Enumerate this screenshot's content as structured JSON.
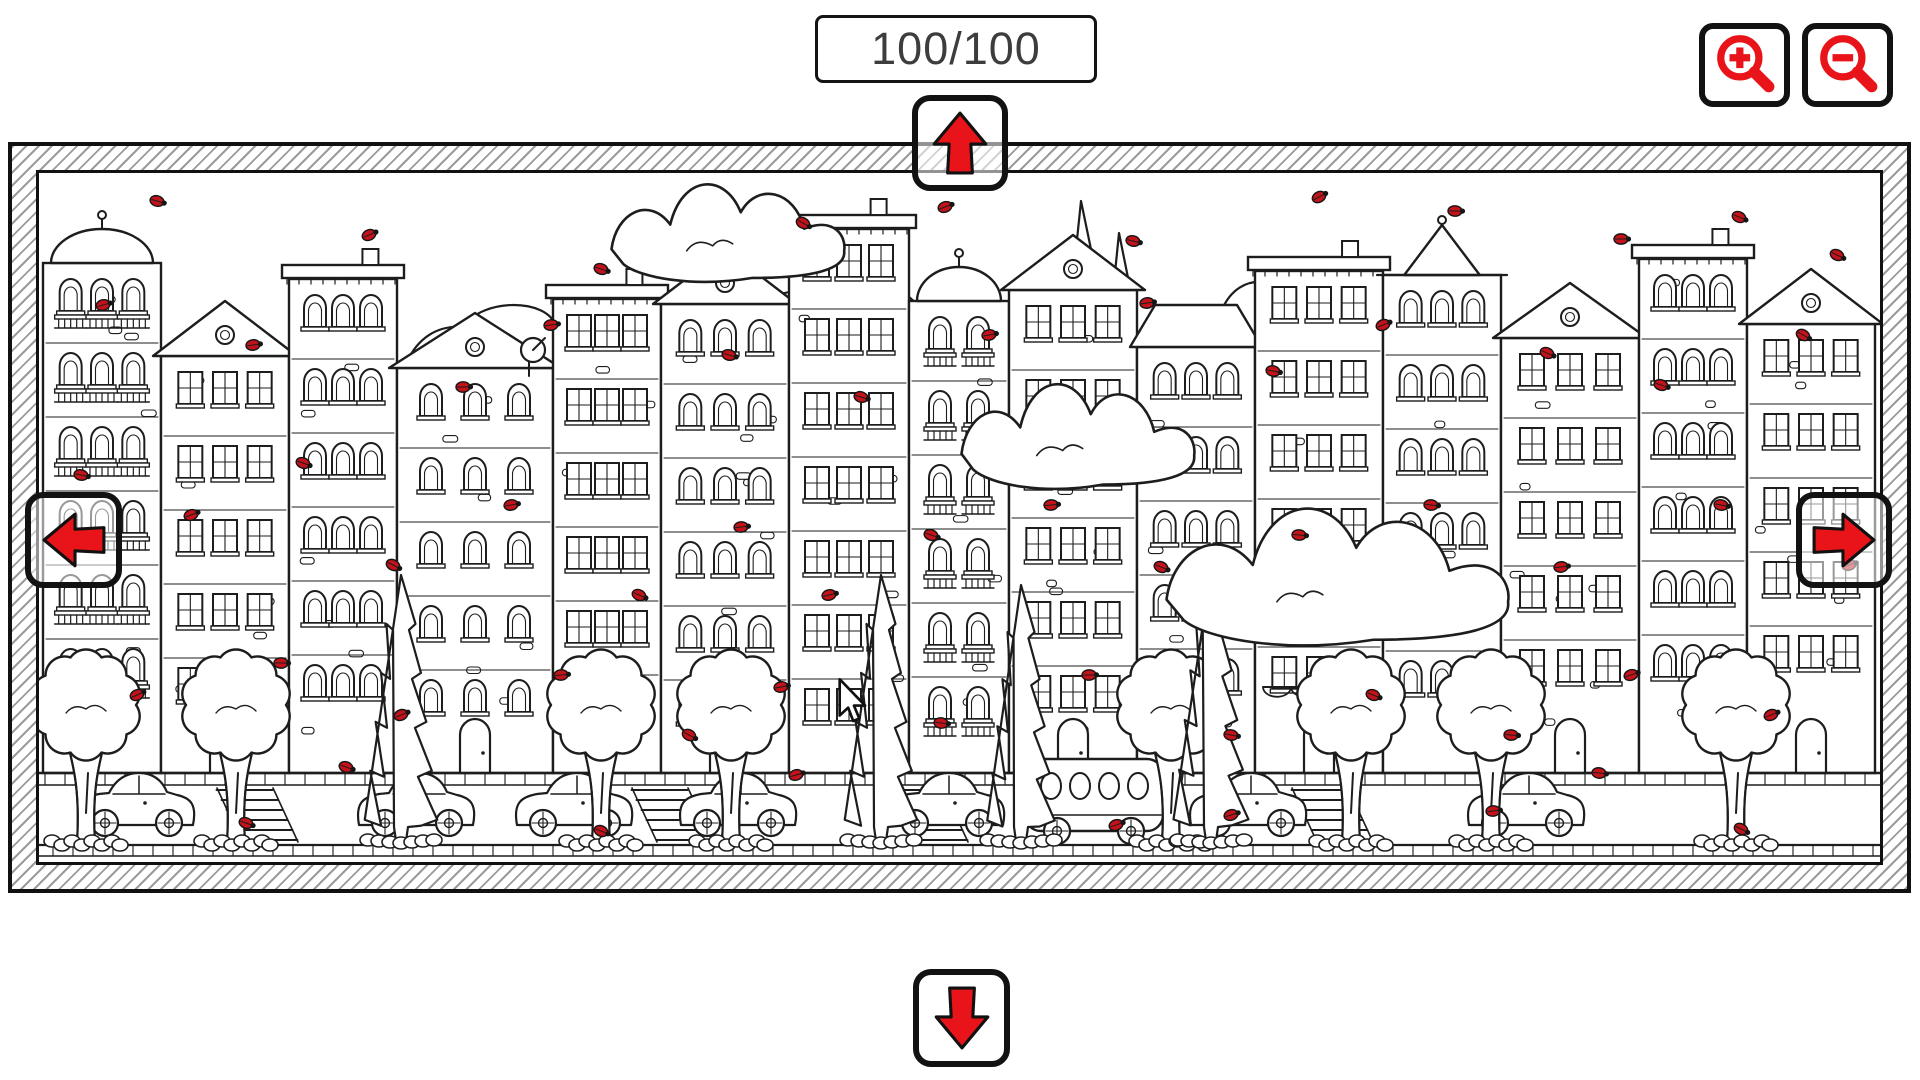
{
  "hud": {
    "counter": "100/100"
  },
  "controls": {
    "zoom_in": {
      "icon": "magnifier-plus-icon"
    },
    "zoom_out": {
      "icon": "magnifier-minus-icon"
    },
    "pan_up": {
      "icon": "arrow-up-icon"
    },
    "pan_down": {
      "icon": "arrow-down-icon"
    },
    "pan_left": {
      "icon": "arrow-left-icon"
    },
    "pan_right": {
      "icon": "arrow-right-icon"
    }
  },
  "cursor": {
    "icon": "mouse-pointer-icon",
    "x": 836,
    "y": 678
  },
  "colors": {
    "accent_red": "#e81419",
    "bug_red": "#c2121a",
    "ink": "#1d1d1d",
    "hatch": "#9b9b9b",
    "counter_text": "#3d3d3d",
    "paper": "#ffffff"
  },
  "scene": {
    "ground_y": 600,
    "road_bottom": 672,
    "bottom_edge": 683,
    "buildings": [
      {
        "x": 4,
        "w": 118,
        "top": 50,
        "roof": "dome",
        "win": "arch",
        "cols": 3,
        "balcony": true
      },
      {
        "x": 122,
        "w": 128,
        "top": 128,
        "roof": "gable",
        "win": "rect",
        "cols": 3,
        "door": true
      },
      {
        "x": 250,
        "w": 108,
        "top": 92,
        "roof": "flat",
        "win": "arch",
        "cols": 3
      },
      {
        "x": 358,
        "w": 156,
        "top": 140,
        "roof": "gable",
        "win": "arch",
        "cols": 3,
        "door": true,
        "dish": true
      },
      {
        "x": 514,
        "w": 108,
        "top": 112,
        "roof": "flat",
        "win": "rect",
        "cols": 3,
        "awning": true
      },
      {
        "x": 622,
        "w": 128,
        "top": 76,
        "roof": "gable",
        "win": "arch",
        "cols": 3,
        "door": true
      },
      {
        "x": 750,
        "w": 120,
        "top": 42,
        "roof": "flat",
        "win": "rect",
        "cols": 3
      },
      {
        "x": 870,
        "w": 100,
        "top": 88,
        "roof": "dome",
        "win": "arch",
        "cols": 2,
        "balcony": true
      },
      {
        "x": 970,
        "w": 128,
        "top": 62,
        "roof": "gable",
        "win": "rect",
        "cols": 3,
        "door": true
      },
      {
        "x": 1098,
        "w": 118,
        "top": 132,
        "roof": "mansard",
        "win": "arch",
        "cols": 3
      },
      {
        "x": 1216,
        "w": 128,
        "top": 84,
        "roof": "flat",
        "win": "rect",
        "cols": 3,
        "door": true,
        "awning": true
      },
      {
        "x": 1344,
        "w": 118,
        "top": 52,
        "roof": "cone",
        "win": "arch",
        "cols": 3
      },
      {
        "x": 1462,
        "w": 138,
        "top": 110,
        "roof": "gable",
        "win": "rect",
        "cols": 3,
        "door": true
      },
      {
        "x": 1600,
        "w": 108,
        "top": 72,
        "roof": "flat",
        "win": "arch",
        "cols": 3
      },
      {
        "x": 1708,
        "w": 128,
        "top": 96,
        "roof": "gable",
        "win": "rect",
        "cols": 3,
        "door": true
      }
    ],
    "bg_clumps": [
      {
        "cx": 470,
        "cy": 210,
        "w": 210,
        "h": 140
      },
      {
        "cx": 800,
        "cy": 170,
        "w": 180,
        "h": 130
      },
      {
        "cx": 1258,
        "cy": 150,
        "w": 150,
        "h": 110
      }
    ],
    "bg_firs": [
      {
        "cx": 1042,
        "apex": 28,
        "base": 330,
        "w": 46
      },
      {
        "cx": 1080,
        "apex": 60,
        "base": 330,
        "w": 40
      }
    ],
    "clouds": [
      {
        "cx": 690,
        "cy": 68,
        "w": 235,
        "h": 82,
        "front": false
      },
      {
        "cx": 1040,
        "cy": 272,
        "w": 235,
        "h": 88,
        "front": false
      },
      {
        "cx": 1300,
        "cy": 415,
        "w": 345,
        "h": 115,
        "front": true
      }
    ],
    "crosswalks": [
      215,
      630,
      885,
      1290
    ],
    "cars": [
      {
        "x": 40
      },
      {
        "x": 320
      },
      {
        "x": 478
      },
      {
        "x": 642
      },
      {
        "x": 850
      },
      {
        "x": 1152
      },
      {
        "x": 1430
      }
    ],
    "bus": {
      "x": 986
    },
    "trees": [
      47,
      197,
      562,
      692,
      1132,
      1312,
      1452,
      1697
    ],
    "pines": [
      {
        "cx": 362,
        "apex": 402,
        "base": 668,
        "w": 58
      },
      {
        "cx": 842,
        "apex": 402,
        "base": 668,
        "w": 58
      },
      {
        "cx": 982,
        "apex": 412,
        "base": 668,
        "w": 54
      },
      {
        "cx": 1172,
        "apex": 398,
        "base": 668,
        "w": 60
      }
    ],
    "ladybugs": [
      [
        118,
        28
      ],
      [
        330,
        62
      ],
      [
        562,
        96
      ],
      [
        764,
        50
      ],
      [
        906,
        34
      ],
      [
        1094,
        68
      ],
      [
        1280,
        24
      ],
      [
        1416,
        38
      ],
      [
        1582,
        66
      ],
      [
        1700,
        44
      ],
      [
        1798,
        82
      ],
      [
        64,
        132
      ],
      [
        214,
        172
      ],
      [
        424,
        214
      ],
      [
        512,
        152
      ],
      [
        690,
        182
      ],
      [
        822,
        224
      ],
      [
        950,
        162
      ],
      [
        1108,
        130
      ],
      [
        1234,
        198
      ],
      [
        1344,
        152
      ],
      [
        1508,
        180
      ],
      [
        1622,
        212
      ],
      [
        1764,
        162
      ],
      [
        42,
        302
      ],
      [
        152,
        342
      ],
      [
        264,
        290
      ],
      [
        354,
        392
      ],
      [
        472,
        332
      ],
      [
        600,
        422
      ],
      [
        702,
        354
      ],
      [
        790,
        422
      ],
      [
        892,
        362
      ],
      [
        1012,
        332
      ],
      [
        1122,
        394
      ],
      [
        1260,
        362
      ],
      [
        1392,
        332
      ],
      [
        1522,
        394
      ],
      [
        1682,
        332
      ],
      [
        1810,
        392
      ],
      [
        98,
        522
      ],
      [
        242,
        490
      ],
      [
        362,
        542
      ],
      [
        522,
        502
      ],
      [
        650,
        562
      ],
      [
        742,
        514
      ],
      [
        902,
        550
      ],
      [
        1050,
        502
      ],
      [
        1192,
        562
      ],
      [
        1334,
        522
      ],
      [
        1472,
        562
      ],
      [
        1592,
        502
      ],
      [
        1732,
        542
      ],
      [
        207,
        650
      ],
      [
        562,
        658
      ],
      [
        757,
        602
      ],
      [
        1077,
        652
      ],
      [
        1192,
        642
      ],
      [
        1454,
        638
      ],
      [
        1702,
        656
      ],
      [
        307,
        594
      ],
      [
        1560,
        600
      ]
    ]
  }
}
